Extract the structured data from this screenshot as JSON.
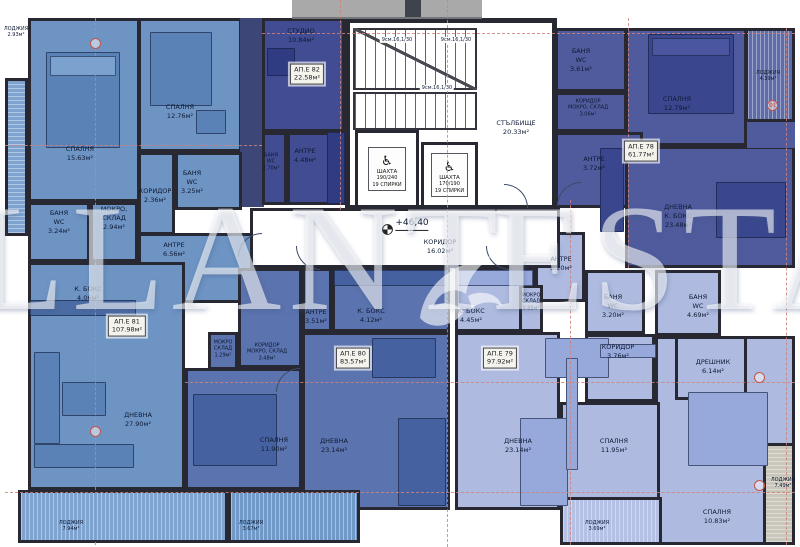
{
  "watermark": {
    "left": "LLANT",
    "right": "ESTA"
  },
  "level_mark": "+46,40",
  "icons": {
    "wheelchair": "♿"
  },
  "markers": {
    "f1": "Ф1"
  },
  "colors": {
    "ap81": "#6e94c4",
    "ap82": "#414c92",
    "ap78": "#4f5b9d",
    "ap80": "#5b73ae",
    "ap79": "#aebadf",
    "wardrobe": "#3c4677",
    "loggia_left": "#7fa3cf",
    "loggia_78": "#5f6caa",
    "loggia_80": "#7199c8",
    "loggia_79": "#b4c0e4",
    "loggia_right": "#c9c7bc",
    "wall": "#272832",
    "axis": "#d0837b"
  },
  "core": {
    "stair_name": "СТЪЛБИЩЕ",
    "stair_area": "20.33м²",
    "flight1": "9см.16,1/30",
    "flight2": "9см.16,1/30",
    "flight3": "9см.16,1/30",
    "corridor_name": "КОРИДОР",
    "corridor_area": "16.02м²",
    "elev_left": {
      "name": "ШАХТА",
      "spec": "190/240\n19 СПИРКИ"
    },
    "elev_right": {
      "name": "ШАХТА",
      "spec": "170/190\n19 СПИРКИ"
    }
  },
  "apartments": {
    "ap81": {
      "id": "АП.Е 81",
      "area": "107.98м²"
    },
    "ap82": {
      "id": "АП.Е 82",
      "area": "22.58м²"
    },
    "ap78": {
      "id": "АП.Е 78",
      "area": "61.77м²"
    },
    "ap80": {
      "id": "АП.Е 80",
      "area": "83.57м²"
    },
    "ap79": {
      "id": "АП.Е 79",
      "area": "97.92м²"
    }
  },
  "rooms": {
    "sp1563": {
      "name": "СПАЛНЯ",
      "area": "15.63м²"
    },
    "sp1276": {
      "name": "СПАЛНЯ",
      "area": "12.76м²"
    },
    "ban325": {
      "name": "БАНЯ\nWC",
      "area": "3.25м²"
    },
    "kor236": {
      "name": "КОРИДОР",
      "area": "2.36м²"
    },
    "ban324": {
      "name": "БАНЯ\nWC",
      "area": "3.24м²"
    },
    "mokro294": {
      "name": "МОКРО,\nСКЛАД",
      "area": "2.94м²"
    },
    "antre81": {
      "name": "АНТРЕ",
      "area": "6.56м²"
    },
    "kbox406": {
      "name": "К. БОКС",
      "area": "4.06м²"
    },
    "dnev2790": {
      "name": "ДНЕВНА",
      "area": "27.90м²"
    },
    "studio": {
      "name": "СТУДИО",
      "area": "10.84м²"
    },
    "ban270": {
      "name": "БАНЯ\nWC",
      "area": "2.70м²"
    },
    "antre448": {
      "name": "АНТРЕ",
      "area": "4.48м²"
    },
    "ban361": {
      "name": "БАНЯ\nWC",
      "area": "3.61м²"
    },
    "kor306": {
      "name": "КОРИДОР\nМОКРО, СКЛАД",
      "area": "3.06м²"
    },
    "sp1279": {
      "name": "СПАЛНЯ",
      "area": "12.79м²"
    },
    "antre78": {
      "name": "АНТРЕ",
      "area": "3.72м²"
    },
    "dnev2348": {
      "name": "ДНЕВНА\nК. БОКС",
      "area": "23.48м²"
    },
    "loggia439": {
      "name": "ЛОДЖИЯ",
      "area": "4.39м²"
    },
    "mokro129": {
      "name": "МОКРО\nСКЛАД",
      "area": "1.29м²"
    },
    "kor348": {
      "name": "КОРИДОР\nМОКРО, СКЛАД",
      "area": "3.48м²"
    },
    "antre351": {
      "name": "АНТРЕ",
      "area": "3.51м²"
    },
    "kbox412": {
      "name": "К. БОКС",
      "area": "4.12м²"
    },
    "sp1190": {
      "name": "СПАЛНЯ",
      "area": "11.90м²"
    },
    "dnev2314a": {
      "name": "ДНЕВНА",
      "area": "23.14м²"
    },
    "kbox445": {
      "name": "К. БОКС",
      "area": "4.45м²"
    },
    "antre520": {
      "name": "АНТРЕ",
      "area": "5.20м²"
    },
    "mokro085": {
      "name": "МОКРО\nСКЛАД",
      "area": "0.85м²"
    },
    "ban320": {
      "name": "БАНЯ\nWC",
      "area": "3.20м²"
    },
    "ban469": {
      "name": "БАНЯ\nWC",
      "area": "4.69м²"
    },
    "kor376": {
      "name": "КОРИДОР",
      "area": "3.76м²"
    },
    "dresh614": {
      "name": "ДРЕШНИК",
      "area": "6.14м²"
    },
    "dnev2314b": {
      "name": "ДНЕВНА",
      "area": "23.14м²"
    },
    "sp1195": {
      "name": "СПАЛНЯ",
      "area": "11.95м²"
    },
    "sp1083": {
      "name": "СПАЛНЯ",
      "area": "10.83м²"
    },
    "loggia369": {
      "name": "ЛОДЖИЯ",
      "area": "3.69м²"
    },
    "loggia749": {
      "name": "ЛОДЖИЯ",
      "area": "7.49м²"
    },
    "loggia293": {
      "name": "ЛОДЖИЯ",
      "area": "2.93м²"
    },
    "loggia794": {
      "name": "ЛОДЖИЯ",
      "area": "7.94м²"
    },
    "loggia367": {
      "name": "ЛОДЖИЯ",
      "area": "3.67м²"
    }
  }
}
